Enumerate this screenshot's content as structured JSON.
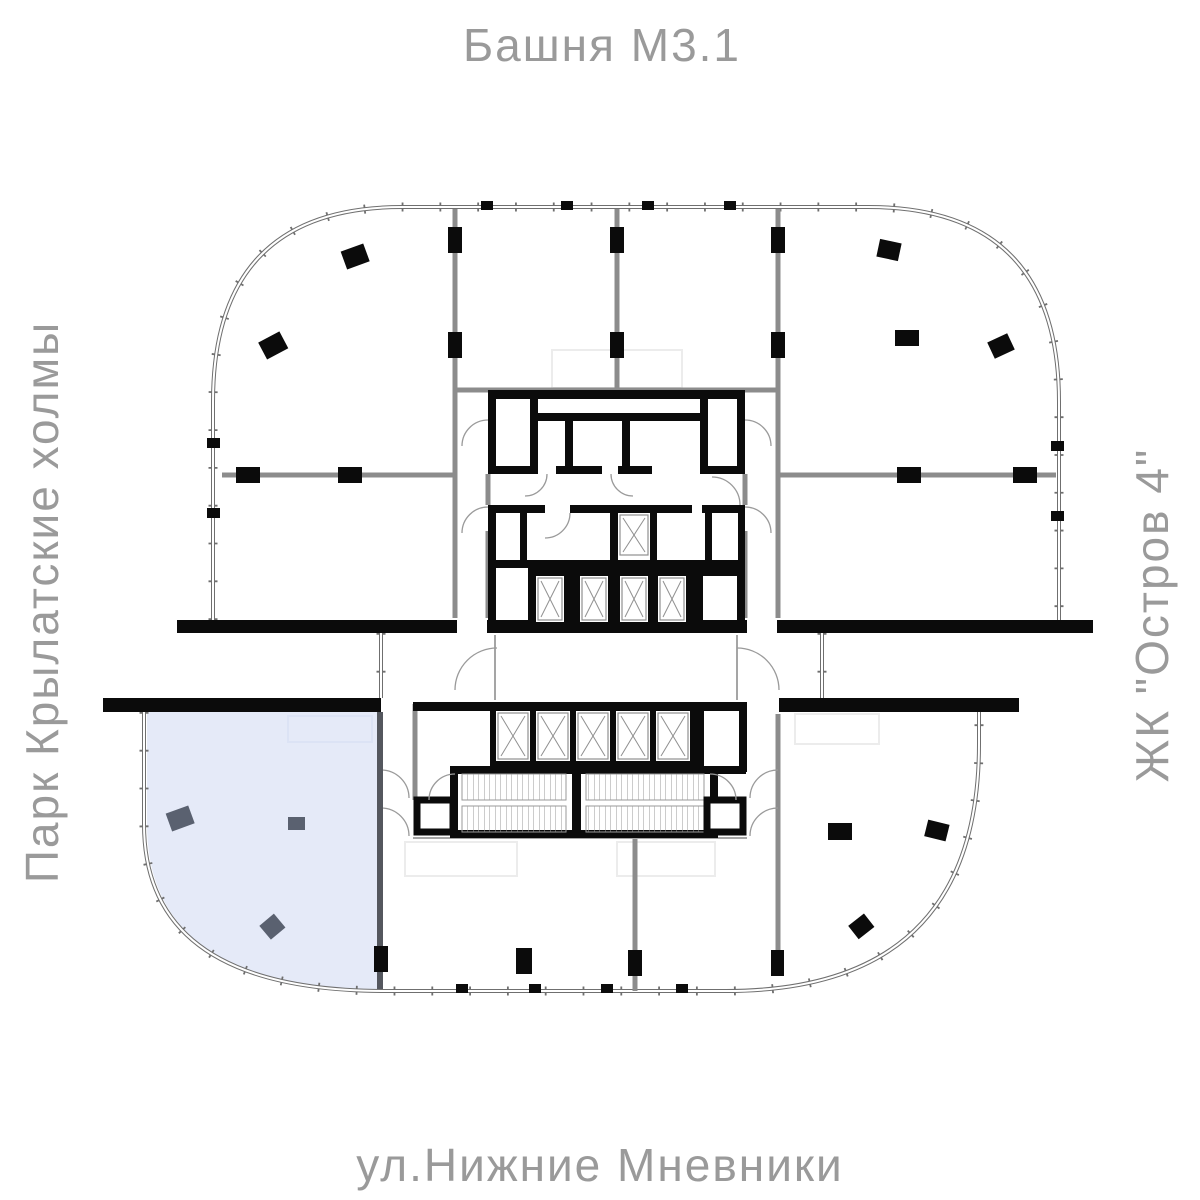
{
  "labels": {
    "top": "Башня М3.1",
    "left": "Парк Крылатские холмы",
    "right": "ЖК \"Остров 4\"",
    "bottom": "ул.Нижние Мневники"
  },
  "colors": {
    "label_text": "#9a9a9a",
    "wall_black": "#0b0b0b",
    "partition_gray": "#8c8c8c",
    "facade_gray": "#6f6f6f",
    "highlight_fill": "#e5eaf8",
    "highlight_wall": "#54575e",
    "column_slate": "#5a6170",
    "background": "#ffffff"
  },
  "plan": {
    "building": "floor plan with central elevator core, two stairwells and one highlighted corner unit",
    "highlighted_unit_position": "bottom-left rounded corner"
  }
}
